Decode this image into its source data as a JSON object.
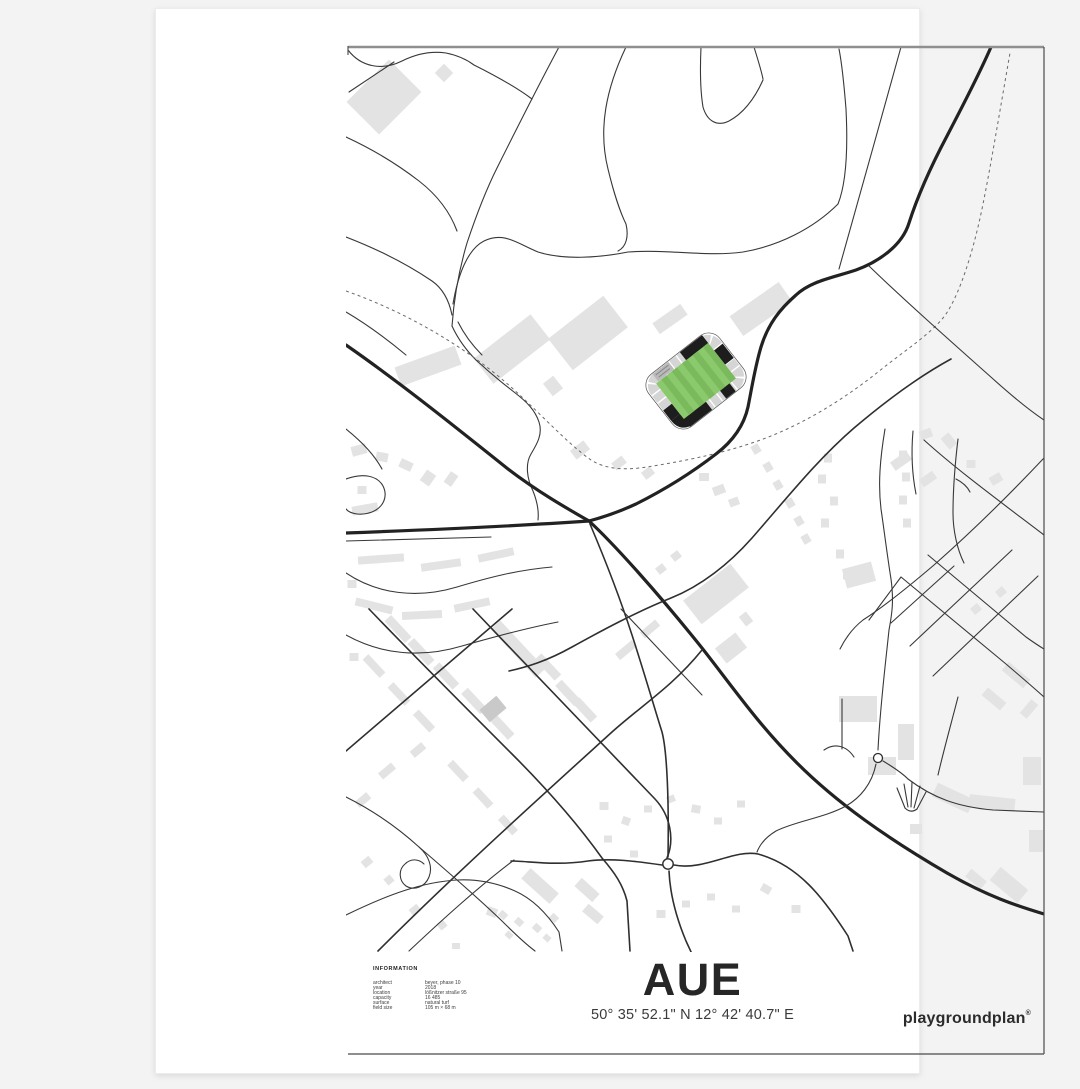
{
  "poster": {
    "title": "AUE",
    "coordinates": "50° 35' 52.1\" N  12° 42' 40.7\" E",
    "brand": {
      "name": "playgroundplan",
      "mark": "®"
    },
    "information": {
      "heading": "INFORMATION",
      "rows": [
        {
          "label": "architect",
          "value": "beyer, phase 10"
        },
        {
          "label": "year",
          "value": "2018"
        },
        {
          "label": "location",
          "value": "lößnitzer straße 95"
        },
        {
          "label": "capacity",
          "value": "16 485"
        },
        {
          "label": "surface",
          "value": "natural turf"
        },
        {
          "label": "field size",
          "value": "105 m × 68 m"
        }
      ]
    },
    "map": {
      "subject": "stadium-erzgebirge-aue-street-map",
      "colors": {
        "page_background": "#f3f3f3",
        "poster_background": "#ffffff",
        "road": "#2f2f2f",
        "building": "#e3e3e3",
        "pitch_green": "#8ac96c",
        "pitch_stripe": "#7bba5c",
        "stand_gray": "#d5d5d5",
        "stand_black": "#1d1d1d"
      }
    }
  }
}
